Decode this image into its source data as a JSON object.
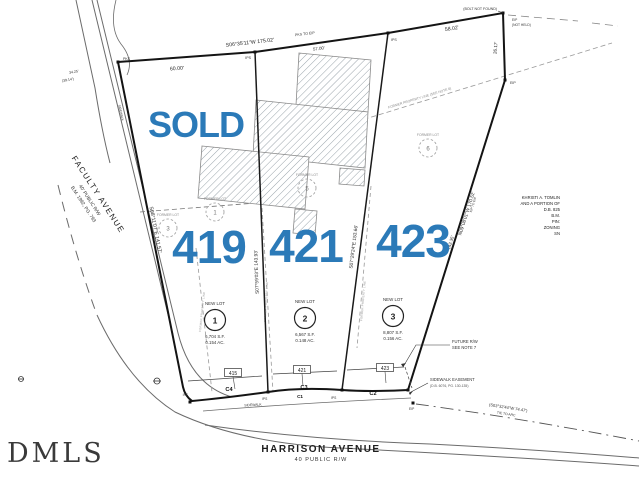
{
  "overlay": {
    "sold": "SOLD",
    "addr1": "419",
    "addr2": "421",
    "addr3": "423",
    "blue": "#2b7ab8"
  },
  "watermark": "DMLS",
  "streets": {
    "faculty_name": "FACULTY  AVENUE",
    "faculty_rw": "40' PUBLIC R/W",
    "faculty_bm": "B.M. 1992, PG. 793",
    "harrison_name": "HARRISON  AVENUE",
    "harrison_rw": "40  PUBLIC  R/W"
  },
  "dims": {
    "top_bearing": "S06°35'11\"W   175.02'",
    "top_sub": "PKS TO EIP",
    "d60": "60.00'",
    "d57": "57.00'",
    "d58": "58.02'",
    "d26": "26.17'",
    "left_bearing": "S08°11'07\"E   141.57'",
    "line12": "S07°59'03\"E   143.93'",
    "line23": "S07°29'24\"E   153.66'",
    "right_bearing": "N09°08'01\"W   170.52'",
    "right_sub": "EIP TO EIP",
    "d142": "142.35'",
    "tie": "(S03°32'44\"W  74.47')",
    "tie2": "TIE TO ARC",
    "corner_a1": "34.25'",
    "corner_a2": "(39.14')"
  },
  "markers": {
    "pks": "PKS",
    "ips": "IPS",
    "eip": "EIP",
    "eip_nh1": "EIP",
    "eip_nh2": "(NOT HELD)",
    "bolt": "(BOLT NOT FOUND)"
  },
  "curves": {
    "c1": "C1",
    "c2": "C2",
    "c3": "C3",
    "c4": "C4"
  },
  "address_boxes": [
    "415",
    "421",
    "423"
  ],
  "new_lots": [
    {
      "t": "NEW  LOT",
      "n": "1",
      "sf": "6,704  S.F.",
      "ac": "0.154  AC."
    },
    {
      "t": "NEW  LOT",
      "n": "2",
      "sf": "6,567  S.F.",
      "ac": "0.148  AC."
    },
    {
      "t": "NEW  LOT",
      "n": "3",
      "sf": "8,807  S.F.",
      "ac": "0.156  AC."
    }
  ],
  "former_lots": [
    {
      "t": "FORMER  LOT",
      "n": "3"
    },
    {
      "t": "FORMER  LOT",
      "n": "1"
    },
    {
      "t": "FORMER  LOT",
      "n": "5"
    },
    {
      "t": "FORMER  LOT",
      "n": "6"
    }
  ],
  "notes": {
    "future_rw1": "FUTURE  R/W",
    "future_rw2": "SEE  NOTE  7",
    "se1": "SIDEWALK  EASEMENT",
    "se2": "(D.B. 6076, PG. 130-135)",
    "fpl6": "FORMER PROPERTY LINE (SEE NOTE 6)",
    "fpl": "FORMER PROPERTY LINE",
    "sidewalk": "SIDEWALK"
  },
  "adjoiner": {
    "lines": [
      "KHRISTI A. TOMLIN",
      "AND A PORTION OF",
      "D.B. 825",
      "B.M.",
      "PIN:",
      "ZONING",
      "SN"
    ]
  }
}
